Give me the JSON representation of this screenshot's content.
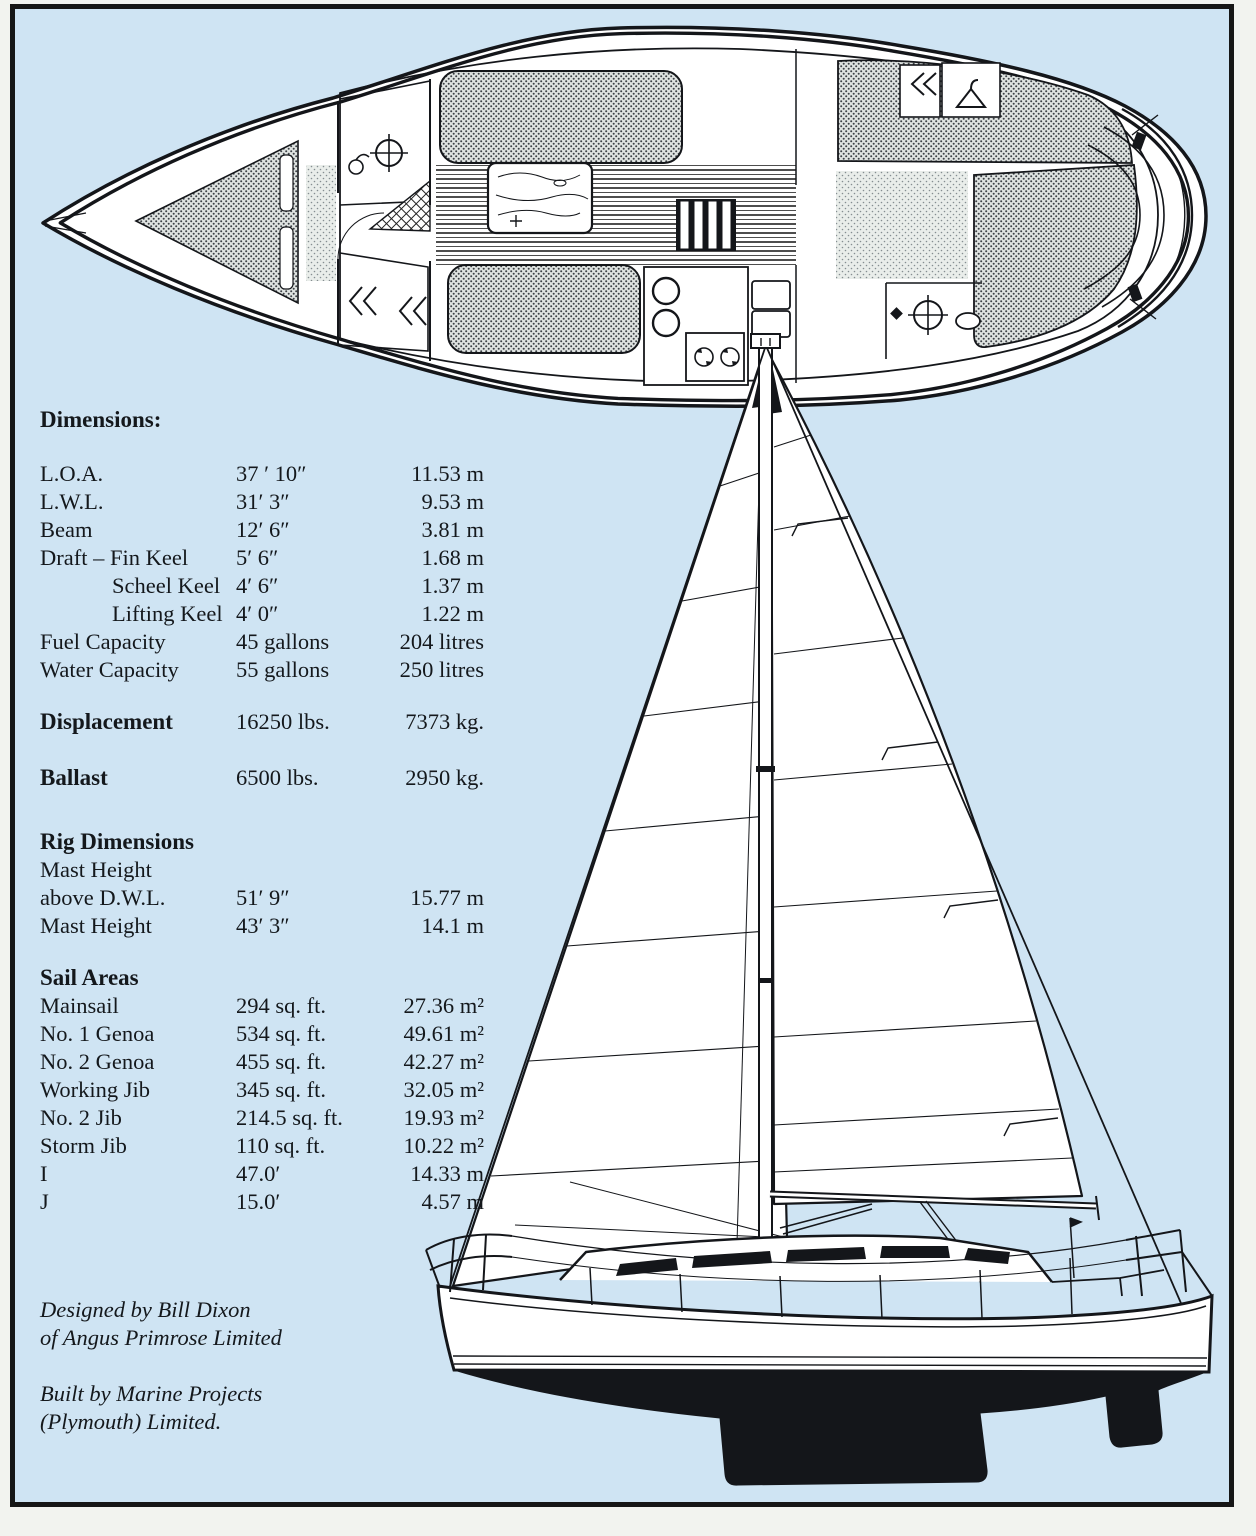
{
  "palette": {
    "page_blue": "#cfe4f3",
    "frame_ink": "#161616",
    "line_ink": "#14161a",
    "text_ink": "#14181c"
  },
  "dimensions": {
    "heading": "Dimensions:",
    "rows": [
      {
        "label": "L.O.A.",
        "imperial": "37 ′ 10″",
        "metric": "11.53 m"
      },
      {
        "label": "L.W.L.",
        "imperial": "31′ 3″",
        "metric": "9.53 m"
      },
      {
        "label": "Beam",
        "imperial": "12′ 6″",
        "metric": "3.81 m"
      },
      {
        "label": "Draft – Fin Keel",
        "imperial": "5′ 6″",
        "metric": "1.68 m"
      },
      {
        "label": "Scheel Keel",
        "imperial": "4′ 6″",
        "metric": "1.37 m"
      },
      {
        "label": "Lifting Keel",
        "imperial": "4′ 0″",
        "metric": "1.22 m"
      },
      {
        "label": "Fuel Capacity",
        "imperial": "45 gallons",
        "metric": "204 litres"
      },
      {
        "label": "Water Capacity",
        "imperial": "55 gallons",
        "metric": "250 litres"
      }
    ]
  },
  "displacement": {
    "label": "Displacement",
    "imperial": "16250 lbs.",
    "metric": "7373 kg."
  },
  "ballast": {
    "label": "Ballast",
    "imperial": "6500 lbs.",
    "metric": "2950 kg."
  },
  "rig": {
    "heading": "Rig Dimensions",
    "rows": [
      {
        "label": "Mast Height",
        "imperial": "",
        "metric": ""
      },
      {
        "label": "above D.W.L.",
        "imperial": "51′ 9″",
        "metric": "15.77 m"
      },
      {
        "label": "Mast Height",
        "imperial": "43′ 3″",
        "metric": "14.1 m"
      }
    ]
  },
  "sails": {
    "heading": "Sail Areas",
    "rows": [
      {
        "label": "Mainsail",
        "imperial": "294 sq. ft.",
        "metric": "27.36 m²"
      },
      {
        "label": "No. 1 Genoa",
        "imperial": "534 sq. ft.",
        "metric": "49.61 m²"
      },
      {
        "label": "No. 2 Genoa",
        "imperial": "455 sq. ft.",
        "metric": "42.27 m²"
      },
      {
        "label": "Working Jib",
        "imperial": "345 sq. ft.",
        "metric": "32.05 m²"
      },
      {
        "label": "No. 2 Jib",
        "imperial": "214.5 sq. ft.",
        "metric": "19.93 m²"
      },
      {
        "label": "Storm Jib",
        "imperial": "110 sq. ft.",
        "metric": "10.22 m²"
      },
      {
        "label": "I",
        "imperial": "47.0′",
        "metric": "14.33 m"
      },
      {
        "label": "J",
        "imperial": "15.0′",
        "metric": "4.57 m"
      }
    ]
  },
  "credits": {
    "designed_line1": "Designed by Bill Dixon",
    "designed_line2": "of Angus Primrose Limited",
    "built_line1": "Built by Marine Projects",
    "built_line2": "(Plymouth) Limited."
  }
}
